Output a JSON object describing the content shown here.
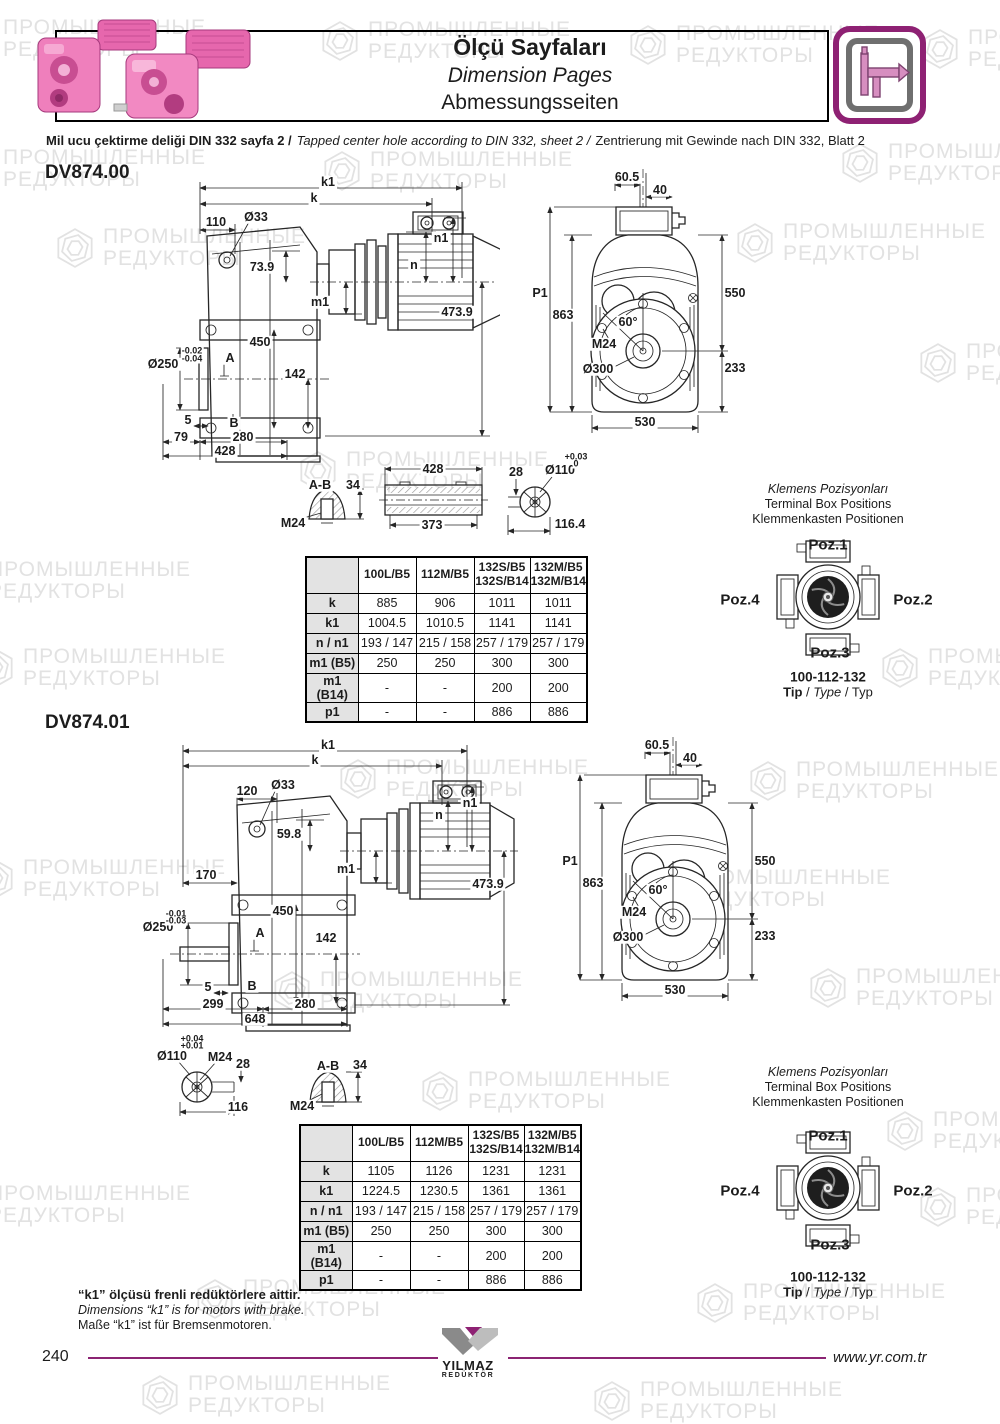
{
  "watermark": {
    "line1": "ПРОМЫШЛЕННЫЕ",
    "line2": "РЕДУКТОРЫ"
  },
  "header": {
    "title_tr": "Ölçü Sayfaları",
    "title_en": "Dimension Pages",
    "title_de": "Abmessungsseiten",
    "note_tr": "Mil ucu çektirme deliği DIN 332 sayfa 2 /",
    "note_en": "Tapped center hole according to DIN 332, sheet 2 /",
    "note_de": "Zentrierung mit Gewinde nach DIN 332, Blatt 2"
  },
  "d0": {
    "model": "DV874.00",
    "side": {
      "k1": "k1",
      "k": "k",
      "w110": "110",
      "d33": "Ø33",
      "h739": "73.9",
      "n1": "n1",
      "n": "n",
      "m1": "m1",
      "v4739": "473.9",
      "v450": "450",
      "d250": "Ø250",
      "tol1": "-0.02",
      "tol2": "-0.04",
      "A": "A",
      "v142": "142",
      "v5": "5",
      "B": "B",
      "v79": "79",
      "v280": "280",
      "v428": "428"
    },
    "front": {
      "v605": "60.5",
      "v40": "40",
      "p1": "P1",
      "v863": "863",
      "v550": "550",
      "ang": "60°",
      "m24": "M24",
      "d300": "Ø300",
      "v233": "233",
      "v530": "530"
    },
    "detail": {
      "ab": "A-B",
      "v34": "34",
      "m24": "M24",
      "v428": "428",
      "v373": "373",
      "v28": "28",
      "d110": "Ø110",
      "tol1": "+0.03",
      "tol2": "0",
      "v1164": "116.4"
    },
    "table": {
      "columns": [
        {
          "l1": "100L/B5",
          "l2": ""
        },
        {
          "l1": "112M/B5",
          "l2": ""
        },
        {
          "l1": "132S/B5",
          "l2": "132S/B14"
        },
        {
          "l1": "132M/B5",
          "l2": "132M/B14"
        }
      ],
      "rows": [
        {
          "label": "k",
          "values": [
            "885",
            "906",
            "1011",
            "1011"
          ]
        },
        {
          "label": "k1",
          "values": [
            "1004.5",
            "1010.5",
            "1141",
            "1141"
          ]
        },
        {
          "label": "n / n1",
          "values": [
            "193 / 147",
            "215 / 158",
            "257 / 179",
            "257 / 179"
          ]
        },
        {
          "label": "m1 (B5)",
          "values": [
            "250",
            "250",
            "300",
            "300"
          ]
        },
        {
          "label": "m1 (B14)",
          "values": [
            "-",
            "-",
            "200",
            "200"
          ]
        },
        {
          "label": "p1",
          "values": [
            "-",
            "-",
            "886",
            "886"
          ]
        }
      ]
    }
  },
  "d1": {
    "model": "DV874.01",
    "side": {
      "k1": "k1",
      "k": "k",
      "w120": "120",
      "d33": "Ø33",
      "h598": "59.8",
      "n1": "n1",
      "n": "n",
      "m1": "m1",
      "v4739": "473.9",
      "v170": "170",
      "v450": "450",
      "d250": "Ø250",
      "tol1": "-0.01",
      "tol2": "-0.03",
      "A": "A",
      "v142": "142",
      "v5": "5",
      "B": "B",
      "v299": "299",
      "v280": "280",
      "v648": "648"
    },
    "front": {
      "v605": "60.5",
      "v40": "40",
      "p1": "P1",
      "v863": "863",
      "v550": "550",
      "ang": "60°",
      "m24": "M24",
      "d300": "Ø300",
      "v233": "233",
      "v530": "530"
    },
    "detail": {
      "d110": "Ø110",
      "tol1": "+0.04",
      "tol2": "+0.01",
      "m24a": "M24",
      "v28": "28",
      "v116": "116",
      "ab": "A-B",
      "v34": "34",
      "m24b": "M24"
    },
    "table": {
      "columns": [
        {
          "l1": "100L/B5",
          "l2": ""
        },
        {
          "l1": "112M/B5",
          "l2": ""
        },
        {
          "l1": "132S/B5",
          "l2": "132S/B14"
        },
        {
          "l1": "132M/B5",
          "l2": "132M/B14"
        }
      ],
      "rows": [
        {
          "label": "k",
          "values": [
            "1105",
            "1126",
            "1231",
            "1231"
          ]
        },
        {
          "label": "k1",
          "values": [
            "1224.5",
            "1230.5",
            "1361",
            "1361"
          ]
        },
        {
          "label": "n / n1",
          "values": [
            "193 / 147",
            "215 / 158",
            "257 / 179",
            "257 / 179"
          ]
        },
        {
          "label": "m1 (B5)",
          "values": [
            "250",
            "250",
            "300",
            "300"
          ]
        },
        {
          "label": "m1 (B14)",
          "values": [
            "-",
            "-",
            "200",
            "200"
          ]
        },
        {
          "label": "p1",
          "values": [
            "-",
            "-",
            "886",
            "886"
          ]
        }
      ]
    }
  },
  "terminal": {
    "title_tr": "Klemens Pozisyonları",
    "title_en": "Terminal Box Positions",
    "title_de": "Klemmenkasten Positionen",
    "poz1": "Poz.1",
    "poz2": "Poz.2",
    "poz3": "Poz.3",
    "poz4": "Poz.4",
    "code": "100-112-132",
    "tip": "Tip",
    "type": "Type",
    "typ": "Typ",
    "sep": "/"
  },
  "footnote": {
    "tr": "“k1” ölçüsü frenli redüktörlere aittir.",
    "en": "Dimensions “k1” is for motors with brake.",
    "de": "Maße “k1” ist für Bremsenmotoren."
  },
  "footer": {
    "page": "240",
    "site": "www.yr.com.tr",
    "logo": "YILMAZ",
    "logo_sub": "REDÜKTÖR"
  }
}
